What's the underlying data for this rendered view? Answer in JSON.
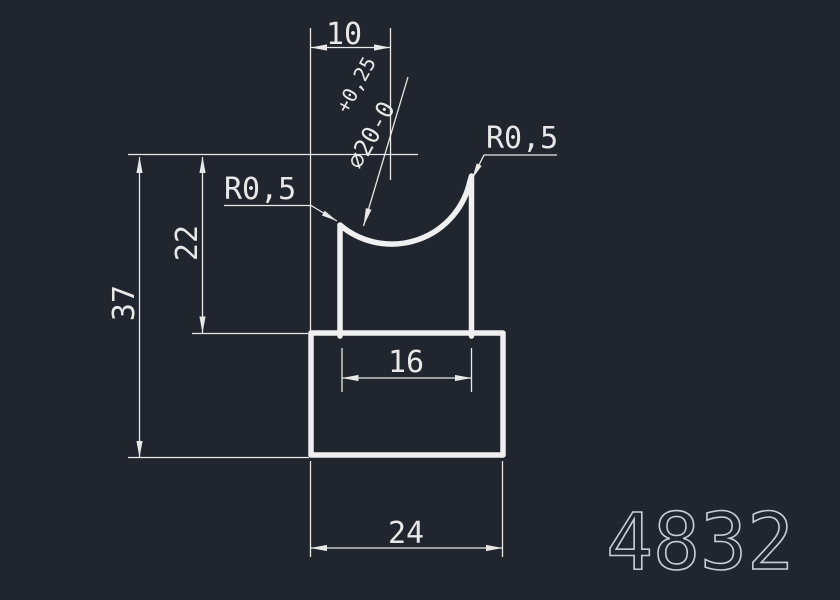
{
  "canvas": {
    "background_color": "#20252e",
    "line_color": "#e8e8e8",
    "part_number_color": "#c9ced6"
  },
  "part_number": "4832",
  "dimensions": {
    "top_width": "10",
    "diameter": "⌀20-0",
    "diameter_tol_upper": "+0,25",
    "radius_right": "R0,5",
    "radius_left": "R0,5",
    "inner_height": "22",
    "total_height": "37",
    "inner_width": "16",
    "bottom_width": "24"
  }
}
